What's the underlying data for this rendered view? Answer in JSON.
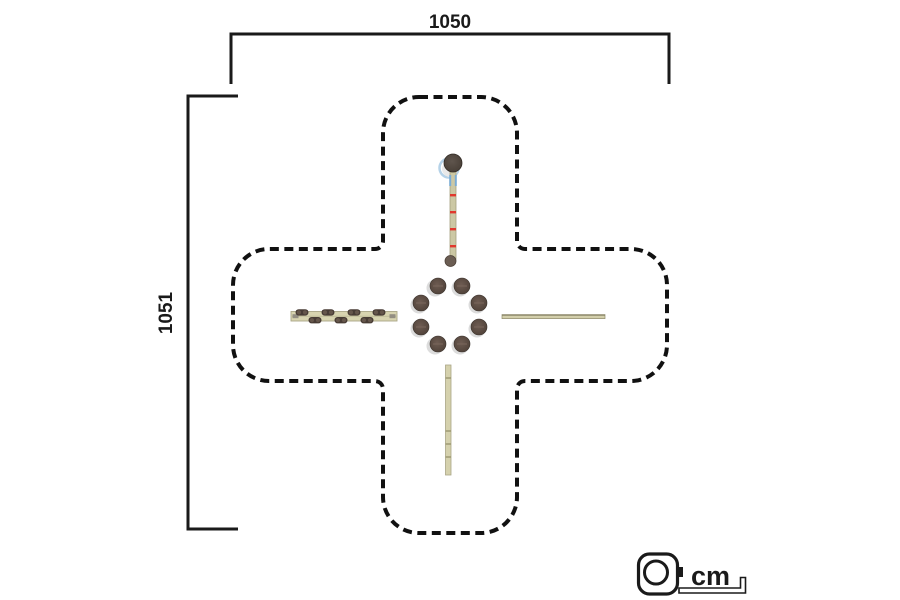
{
  "diagram": {
    "type": "playground-equipment-plan-top-view",
    "dimensions": {
      "width_label": "1050",
      "height_label": "1051"
    },
    "units": {
      "label": "cm",
      "icon": "tape-measure-icon"
    },
    "safety_zone": {
      "shape": "rounded-cross",
      "outline_style": "dashed"
    },
    "equipment": {
      "center_post_ring_count": 8,
      "left_beam_pod_count": 7,
      "arms": [
        "top-striped-pole-with-knob",
        "left-stepping-pod-beam",
        "right-thin-beam",
        "bottom-segmented-beam"
      ]
    },
    "colors": {
      "background": "#ffffff",
      "line": "#1a1a1a",
      "dashed_outline": "#111111",
      "beam_fill": "#d8d4b0",
      "beam_border": "#a9a585",
      "post_fill": "#54453e",
      "red_mark": "#e0392e",
      "blue_mark": "#7aabd4",
      "shadow": "#dcdcdc"
    }
  }
}
